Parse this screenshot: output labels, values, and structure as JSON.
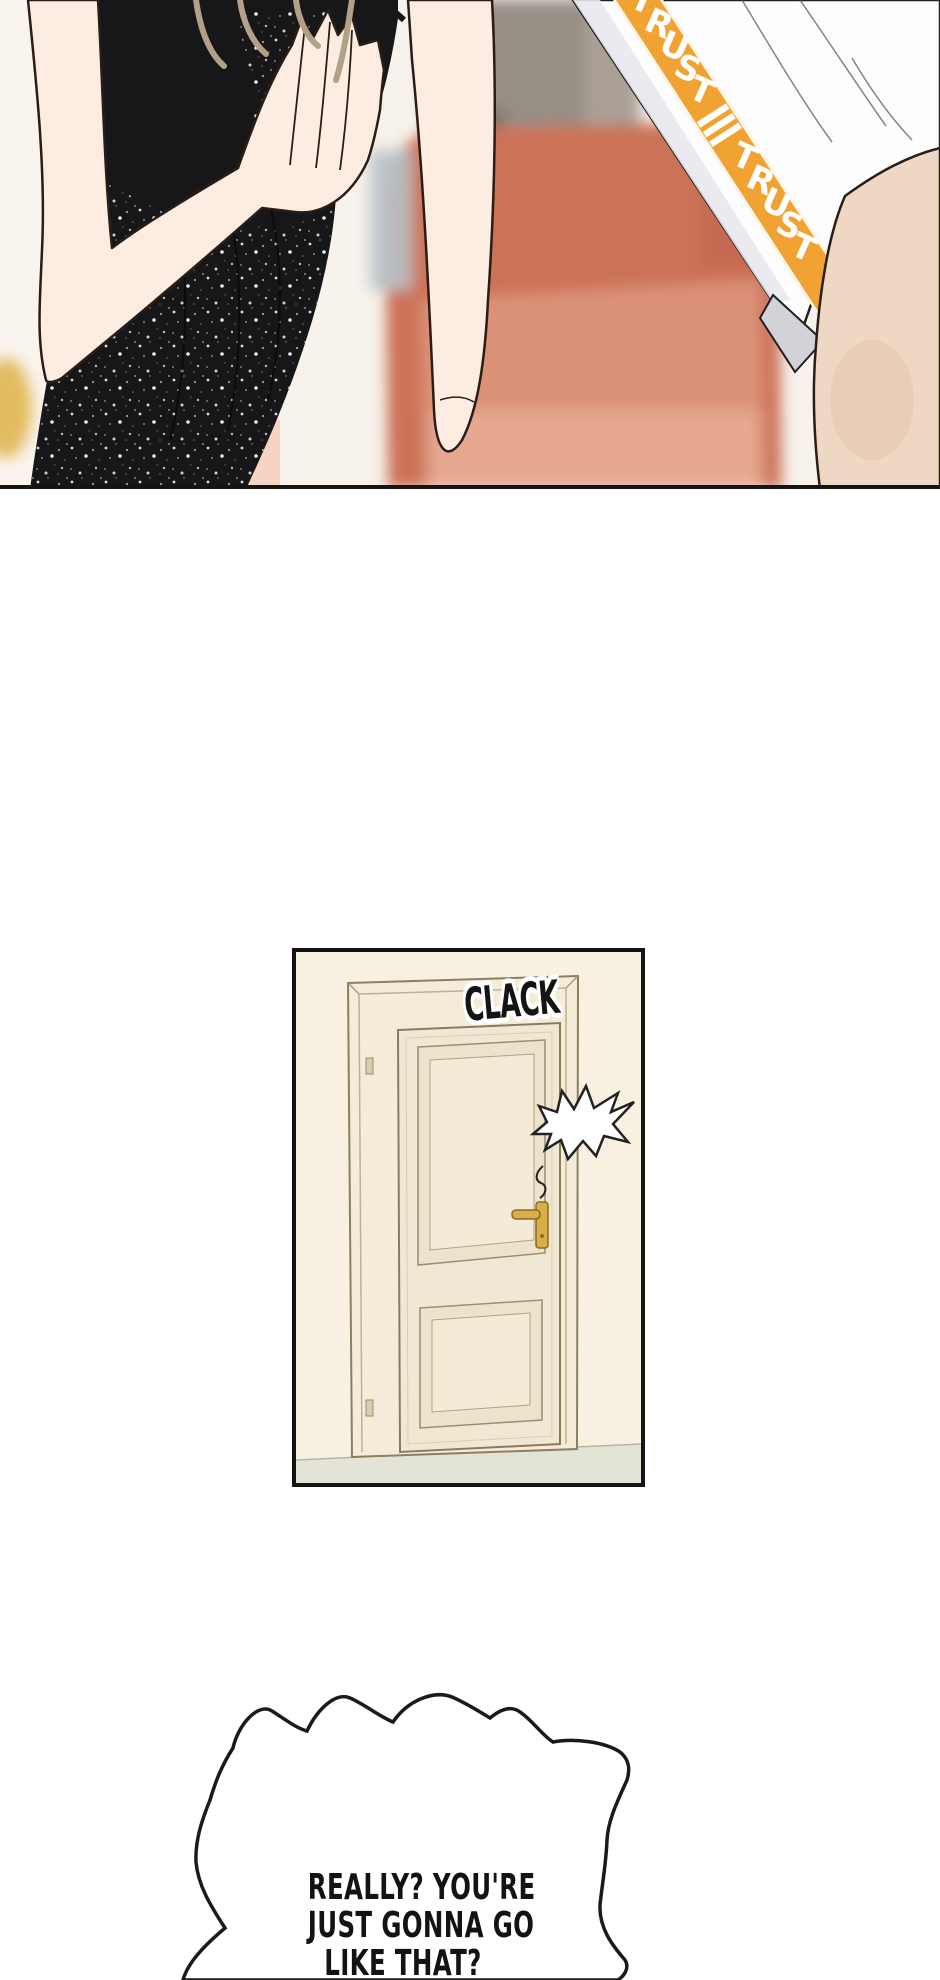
{
  "page": {
    "background": "#FFFFFF"
  },
  "panel1": {
    "trust_band": {
      "segments": [
        "≡",
        "TRUST",
        "≡",
        "TRUST"
      ],
      "band_color": "#F0A232",
      "text_color": "#FFFFFF"
    },
    "colors": {
      "couch": "#CC7257",
      "couch_light": "#DD977E",
      "dress": "#17171A",
      "skin": "#FDECE2",
      "leg_skin": "#EFD8C3",
      "shorts": "#FDFDFE"
    }
  },
  "door_panel": {
    "sfx": "CLACK",
    "colors": {
      "wall": "#F8F1E2",
      "door": "#F1E8D4",
      "trim": "#F4ECD9",
      "handle_gold": "#D9AE49",
      "floor": "#E3E4D5"
    }
  },
  "speech_bubble": {
    "lines": [
      "REALLY? YOU'RE",
      "JUST GONNA GO",
      "LIKE THAT?"
    ],
    "text_color": "#131313"
  }
}
